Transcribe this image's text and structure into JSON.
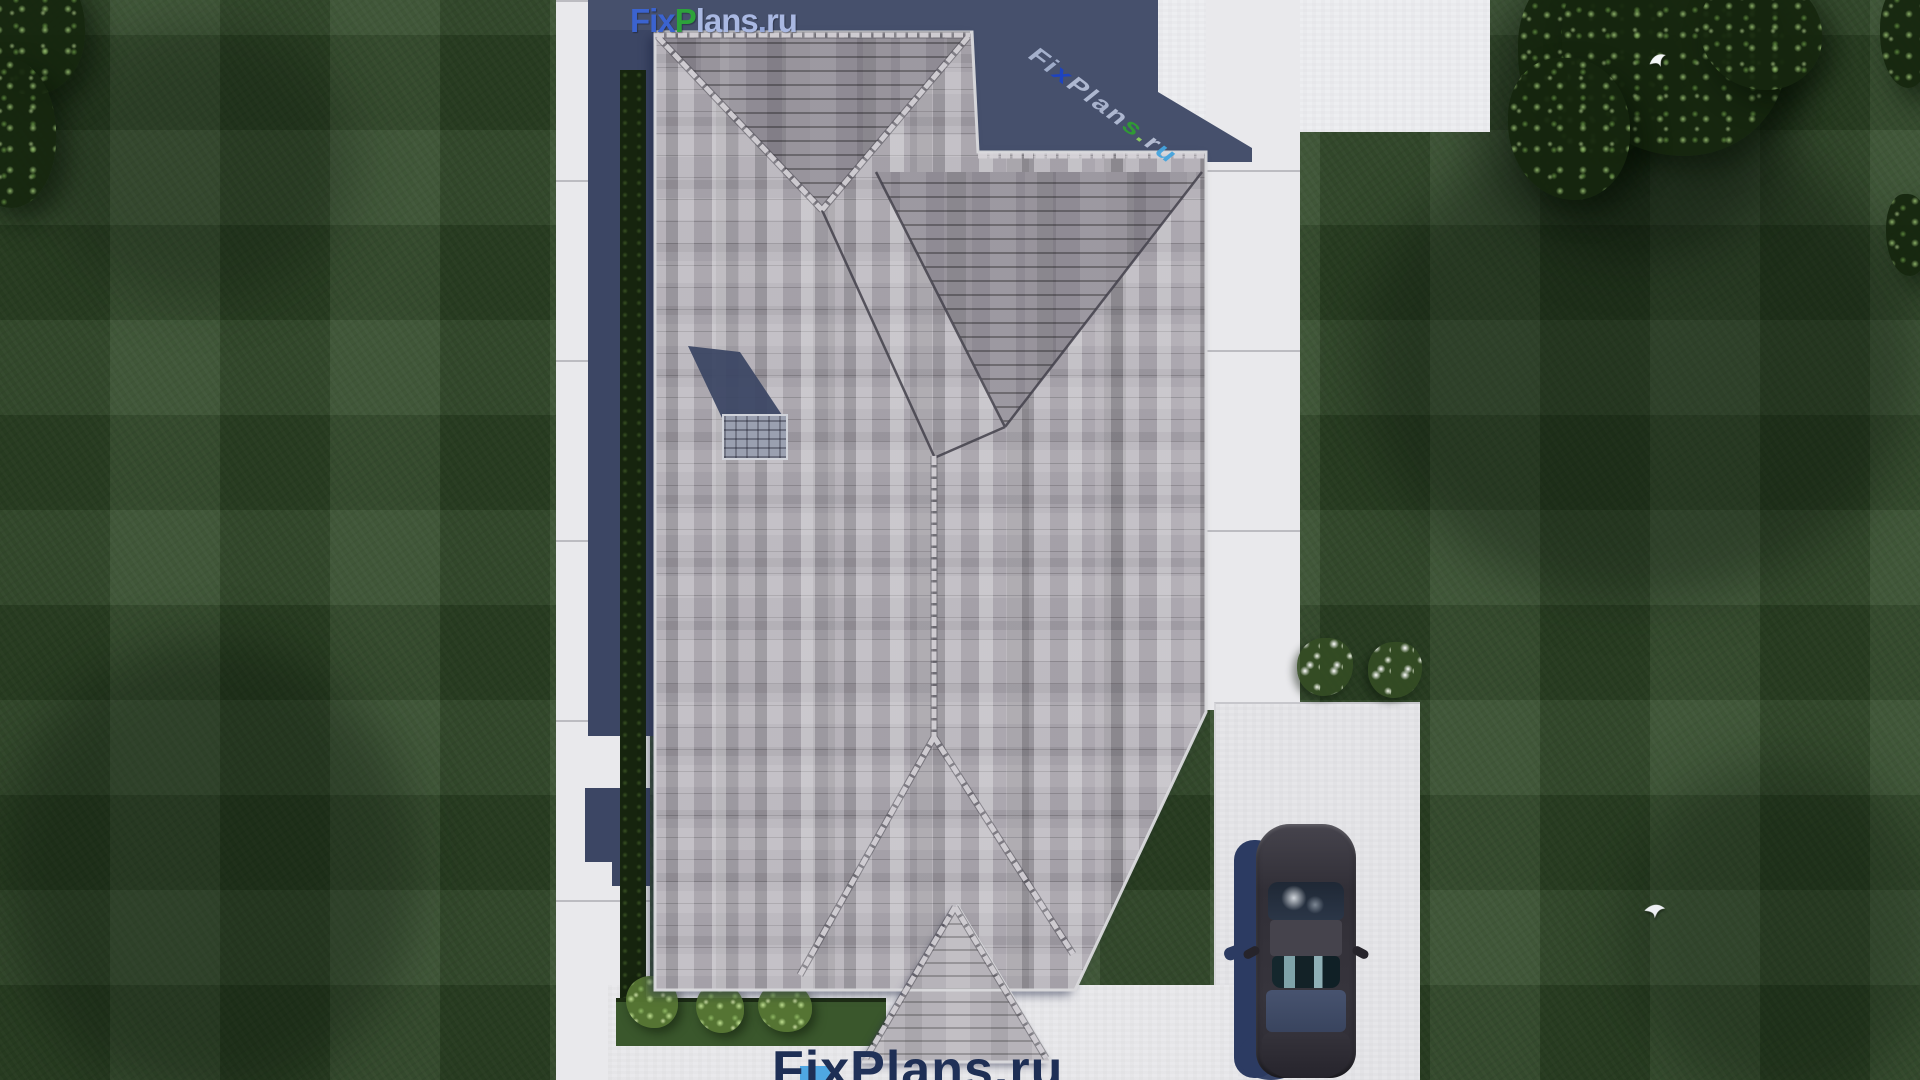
{
  "site": {
    "brand": "FixPlans.ru"
  },
  "watermarks": {
    "top": {
      "text": "FixPlans.ru",
      "letters": [
        {
          "ch": "F",
          "color": "#3b63cf"
        },
        {
          "ch": "i",
          "color": "#3b63cf"
        },
        {
          "ch": "x",
          "color": "#3b63cf"
        },
        {
          "ch": "P",
          "color": "#2da23b"
        },
        {
          "ch": "l",
          "color": "#a9b8e2"
        },
        {
          "ch": "a",
          "color": "#a9b8e2"
        },
        {
          "ch": "n",
          "color": "#a9b8e2"
        },
        {
          "ch": "s",
          "color": "#a9b8e2"
        },
        {
          "ch": ".",
          "color": "#93a6d8"
        },
        {
          "ch": "r",
          "color": "#a9b8e2"
        },
        {
          "ch": "u",
          "color": "#a9b8e2"
        }
      ]
    },
    "ground": {
      "text": "FixPlans.ru",
      "letters": [
        {
          "ch": "F",
          "color": "#aab6d2"
        },
        {
          "ch": "i",
          "color": "#a3b0cd"
        },
        {
          "ch": "x",
          "color": "#1c43c4"
        },
        {
          "ch": "P",
          "color": "#b3bdd6"
        },
        {
          "ch": "l",
          "color": "#b3bdd6"
        },
        {
          "ch": "a",
          "color": "#aeb8d2"
        },
        {
          "ch": "n",
          "color": "#b3bdd6"
        },
        {
          "ch": "s",
          "color": "#2f9e33"
        },
        {
          "ch": ".",
          "color": "#8fce62"
        },
        {
          "ch": "r",
          "color": "#b9c2d8"
        },
        {
          "ch": "u",
          "color": "#45a4de"
        }
      ]
    },
    "bottom": {
      "text": "FixPlans.ru",
      "letters": [
        {
          "ch": "F",
          "color": "#1e2f55"
        },
        {
          "ch": "i",
          "color": "#1e2f55"
        },
        {
          "ch": "x",
          "color": "#1e2f55"
        },
        {
          "ch": "P",
          "color": "#203158"
        },
        {
          "ch": "l",
          "color": "#1e2f55"
        },
        {
          "ch": "a",
          "color": "#1e2f55"
        },
        {
          "ch": "n",
          "color": "#203158"
        },
        {
          "ch": "s",
          "color": "#1e2f55"
        },
        {
          "ch": ".",
          "color": "#1e2f55"
        },
        {
          "ch": "r",
          "color": "#1e2f55"
        },
        {
          "ch": "u",
          "color": "#1e2f55"
        }
      ]
    }
  },
  "palette": {
    "lawn_green": "#2f4827",
    "path_white": "#e9e9ec",
    "shadow_navy": "#46506c",
    "roof_light": "#c2bfc5",
    "roof_mid": "#a5a1a9",
    "roof_dark": "#8a8690",
    "ridge_cap": "#d6d3d8",
    "hedge_dark": "#16240e",
    "bush_green": "#9cc56a",
    "flower_white": "#ffffff",
    "car_body": "#38363e",
    "car_glass_teal": "#15272d",
    "car_deck_blue": "#3f4b66",
    "car_shadow": "#2c3b62",
    "chimney_gray": "#9aa0b0",
    "brand_blue": "#3b63cf",
    "brand_green": "#2da23b",
    "brand_light_blue": "#a9b8e2"
  },
  "scene": {
    "view": "aerial top-down render",
    "counts": {
      "flower_bushes": 2,
      "birds": 2,
      "green_bushes": 3,
      "cars": 1
    }
  }
}
